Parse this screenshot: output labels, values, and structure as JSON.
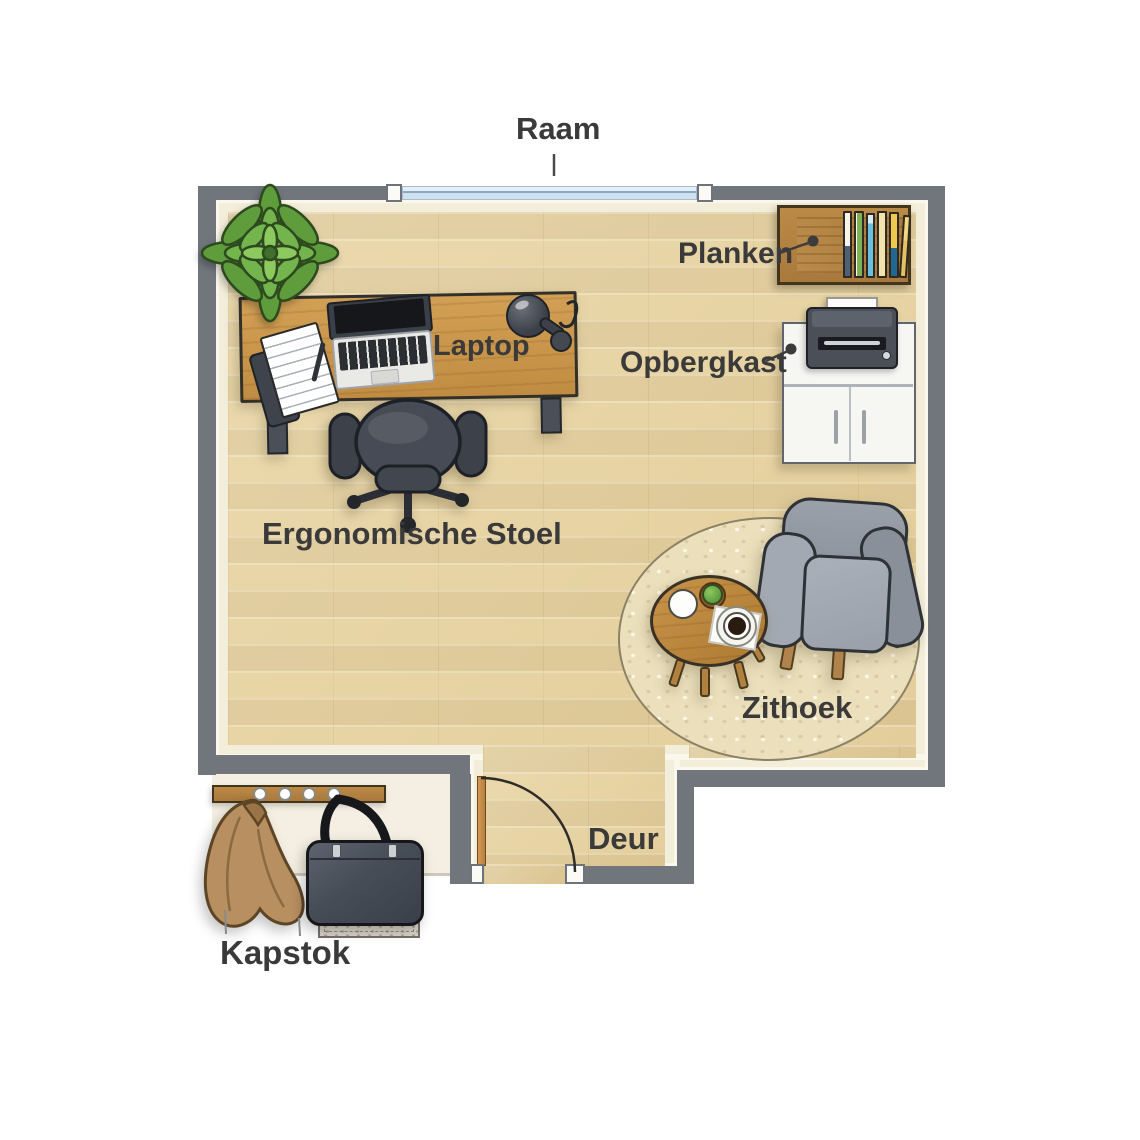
{
  "figure": {
    "type": "floor-plan",
    "language": "nl",
    "rooms": 1
  },
  "labels": {
    "window": "Raam",
    "shelves": "Planken",
    "storage_cabinet": "Opbergkast",
    "laptop": "Laptop",
    "ergonomic_chair": "Ergonomische Stoel",
    "sitting_area": "Zithoek",
    "door": "Deur",
    "coat_rack": "Kapstok"
  },
  "objects": [
    "window",
    "wall-shelf-with-books",
    "printer",
    "storage-cabinet",
    "potted-plant",
    "desk",
    "laptop",
    "notebook",
    "smartphone",
    "pen",
    "desk-lamp",
    "office-chair",
    "round-rug",
    "coffee-table",
    "mug",
    "small-plant",
    "coffee-cup-on-saucer",
    "armchair",
    "door-swing",
    "coat-rack",
    "coat",
    "bag",
    "doormat"
  ],
  "colors": {
    "wall_grey": "#71767d",
    "trim_cream": "#f3eeda",
    "floor_wood": "#e8d6a8",
    "desk_wood": "#c9964c",
    "shelf_wood": "#ad7d3e",
    "charcoal": "#3d424b",
    "armchair_grey": "#939aa3",
    "rug_cream": "#ebdfbc",
    "window_glass": "#d6e5f1",
    "coat_tan": "#b78f60",
    "label_text": "#3a3a3a"
  },
  "books": [
    {
      "name": "book-white-blue",
      "css": "linear-gradient(#f7f4ea 52%, #4e6177 52%)"
    },
    {
      "name": "book-green",
      "css": "linear-gradient(90deg,#ffffff 18%, #7cb454 18%)"
    },
    {
      "name": "book-cyan",
      "css": "linear-gradient(#d8ecf2 14%, #68c0de 14%)"
    },
    {
      "name": "book-cream",
      "css": "#f1e3ad"
    },
    {
      "name": "book-yellow-blue",
      "css": "linear-gradient(#eec94e 55%, #20688f 55%)"
    },
    {
      "name": "book-tan",
      "css": "linear-gradient(#f1d77e 40%, #e3c261 40%)"
    }
  ]
}
